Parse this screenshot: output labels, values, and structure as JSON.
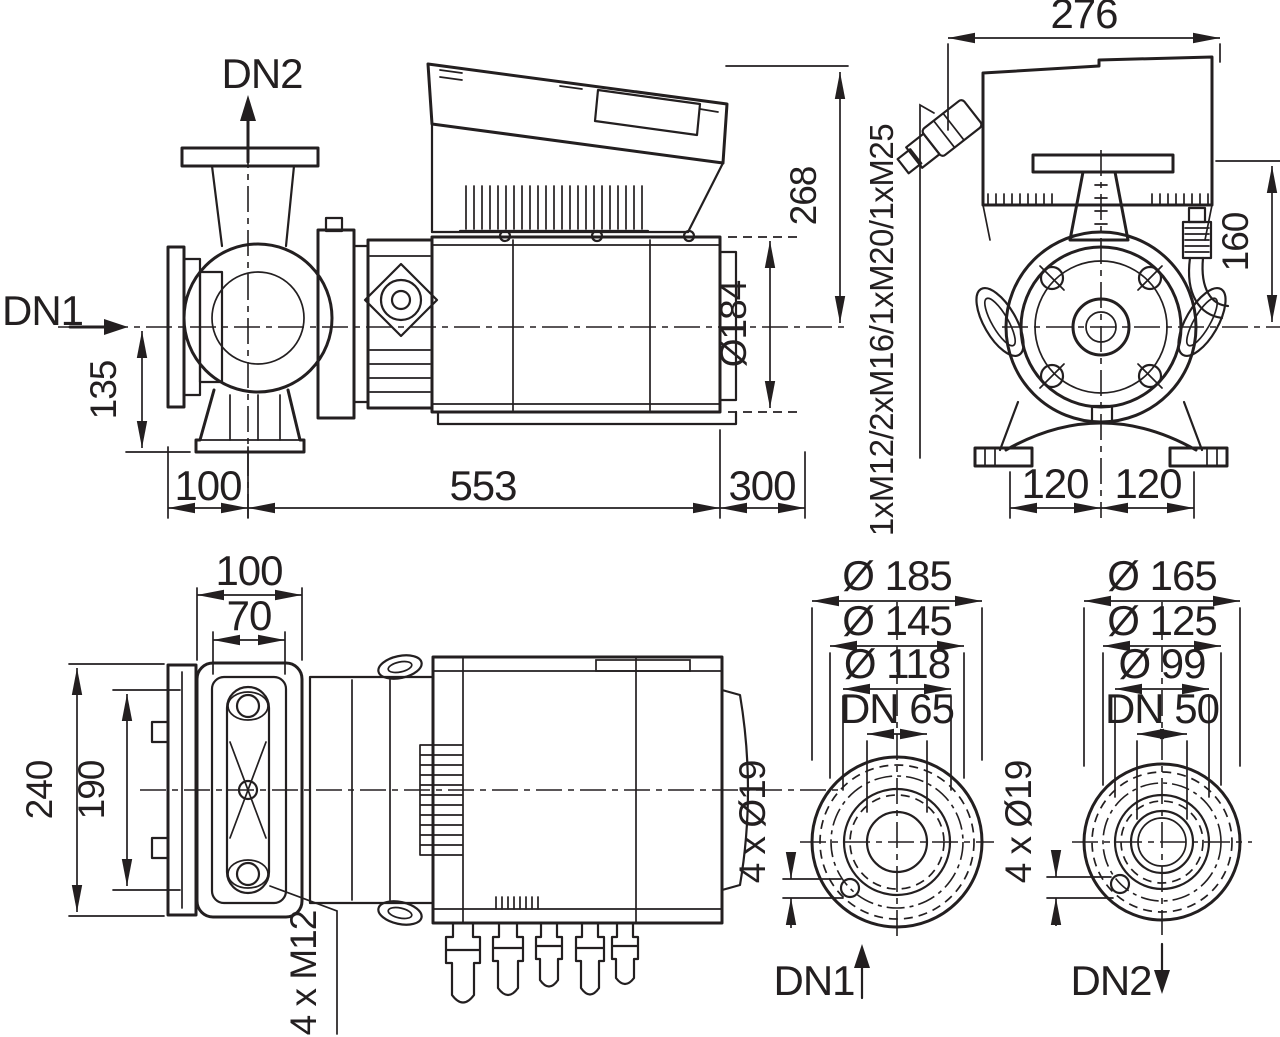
{
  "colors": {
    "ink": "#231f20",
    "background": "#ffffff"
  },
  "views": {
    "side": {
      "port_in": "DN1",
      "port_out": "DN2",
      "dim_axis_to_foot": "135",
      "dim_face_to_axis": "100",
      "dim_axis_to_motor_end": "553",
      "dim_dismantling_clearance": "300",
      "dim_top_to_axis": "268",
      "dim_motor_diameter": "Ø184"
    },
    "front": {
      "dim_module_width": "276",
      "dim_flange_to_axis": "160",
      "dim_foot_left": "120",
      "dim_foot_right": "120",
      "cable_glands": "1xM12/2xM16/1xM20/1xM25"
    },
    "plan": {
      "dim_flange_width": "100",
      "dim_bolt_spacing": "70",
      "dim_overall_depth": "240",
      "dim_inner_depth": "190",
      "bolts": "4 x M12"
    },
    "flange_dn1": {
      "outer_diameter": "Ø 185",
      "bolt_circle": "Ø 145",
      "raised_face": "Ø 118",
      "nominal_bore": "DN 65",
      "bolt_holes": "4 x Ø19",
      "port": "DN1"
    },
    "flange_dn2": {
      "outer_diameter": "Ø 165",
      "bolt_circle": "Ø 125",
      "raised_face": "Ø 99",
      "nominal_bore": "DN 50",
      "bolt_holes": "4 x Ø19",
      "port": "DN2"
    }
  }
}
